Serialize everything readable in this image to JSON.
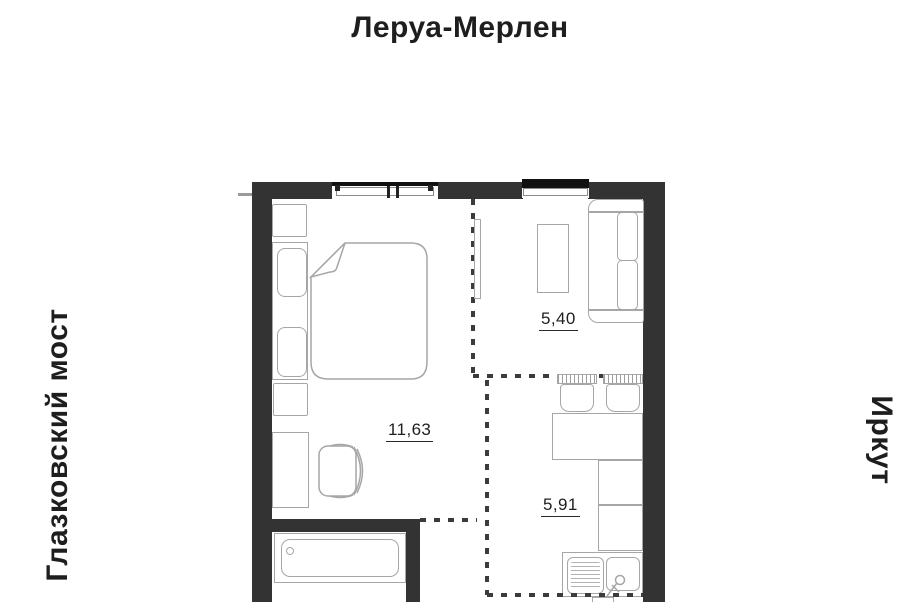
{
  "page": {
    "title": "Леруа-Мерлен"
  },
  "landmarks": {
    "left": "Глазковский мост",
    "right": "Иркут"
  },
  "rooms": {
    "living": {
      "label": "11,63"
    },
    "lounge": {
      "label": "5,40"
    },
    "kitchen": {
      "label": "5,91"
    }
  },
  "icons": [
    "window-icon",
    "double-bed-icon",
    "pillow-icon",
    "nightstand-icon",
    "desk-icon",
    "desk-chair-icon",
    "tv-panel-icon",
    "coffee-table-icon",
    "sofa-icon",
    "bar-chair-icon",
    "dining-table-icon",
    "kitchen-counter-icon",
    "kitchen-sink-icon",
    "faucet-icon",
    "bathtub-icon"
  ],
  "colors": {
    "wall": "#333333",
    "furniture_stroke": "#a6a6a6",
    "dash": "#3b3b3b",
    "text": "#1e1e1e",
    "background": "#ffffff"
  }
}
